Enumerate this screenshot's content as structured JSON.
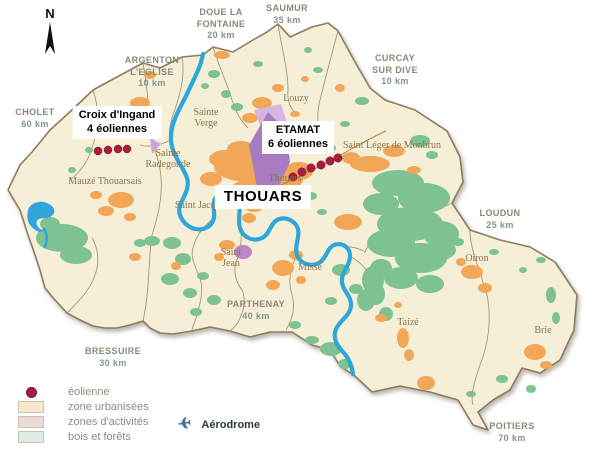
{
  "north": {
    "label": "N"
  },
  "destinations": {
    "cholet": {
      "l1": "CHOLET",
      "l2": "60 km"
    },
    "doue": {
      "l1": "DOUE LA",
      "l2": "FONTAINE",
      "l3": "20 km"
    },
    "saumur": {
      "l1": "SAUMUR",
      "l2": "35 km"
    },
    "curcay": {
      "l1": "CURCAY",
      "l2": "SUR DIVE",
      "l3": "10 km"
    },
    "argenton": {
      "l1": "ARGENTON",
      "l2": "L'EGLISE",
      "l3": "10 km"
    },
    "loudun": {
      "l1": "LOUDUN",
      "l2": "25 km"
    },
    "parthenay": {
      "l1": "PARTHENAY",
      "l2": "40 km"
    },
    "bressuire": {
      "l1": "BRESSUIRE",
      "l2": "30 km"
    },
    "poitiers": {
      "l1": "POITIERS",
      "l2": "70 km"
    }
  },
  "annotations": {
    "croix": {
      "l1": "Croix d'Ingand",
      "l2": "4 éoliennes"
    },
    "etamat": {
      "l1": "ETAMAT",
      "l2": "6 éoliennes"
    },
    "thouars_city": "THOUARS"
  },
  "towns": {
    "sainte_verge": {
      "l1": "Sainte",
      "l2": "Verge"
    },
    "louzy": {
      "l1": "Louzy"
    },
    "sainte_radegonde": {
      "l1": "Sainte",
      "l2": "Radegonde"
    },
    "mauze": {
      "l1": "Mauzé Thouarsais"
    },
    "saint_jacques": {
      "l1": "Saint Jacques"
    },
    "saint_jean": {
      "l1": "Saint",
      "l2": "Jean"
    },
    "thouars_town": {
      "l1": "Thouars"
    },
    "misse": {
      "l1": "Missé"
    },
    "saint_leger": {
      "l1": "Saint Léger de Monbrun"
    },
    "taize": {
      "l1": "Taizé"
    },
    "oiron": {
      "l1": "Oiron"
    },
    "brie": {
      "l1": "Brie"
    }
  },
  "legend": {
    "eolienne": "éolienne",
    "urbanisees": "zone urbanisées",
    "activites": "zones d'activités",
    "bois": "bois et forêts",
    "aerodrome": "Aérodrome",
    "aerodrome_icon": "plane-icon"
  },
  "colors": {
    "district_fill": "#f6efd7",
    "district_border": "#8d7b62",
    "urban": "#f1a757",
    "forest": "#7dc290",
    "activity_dark": "#a87cc0",
    "activity_light": "#d6b6e0",
    "river": "#2ea6da",
    "turbine_dot": "#a81e3e",
    "legend_urban_swatch": "#f8e9cd",
    "legend_activity_swatch": "#eadbd8",
    "legend_forest_swatch": "#dfece3"
  }
}
